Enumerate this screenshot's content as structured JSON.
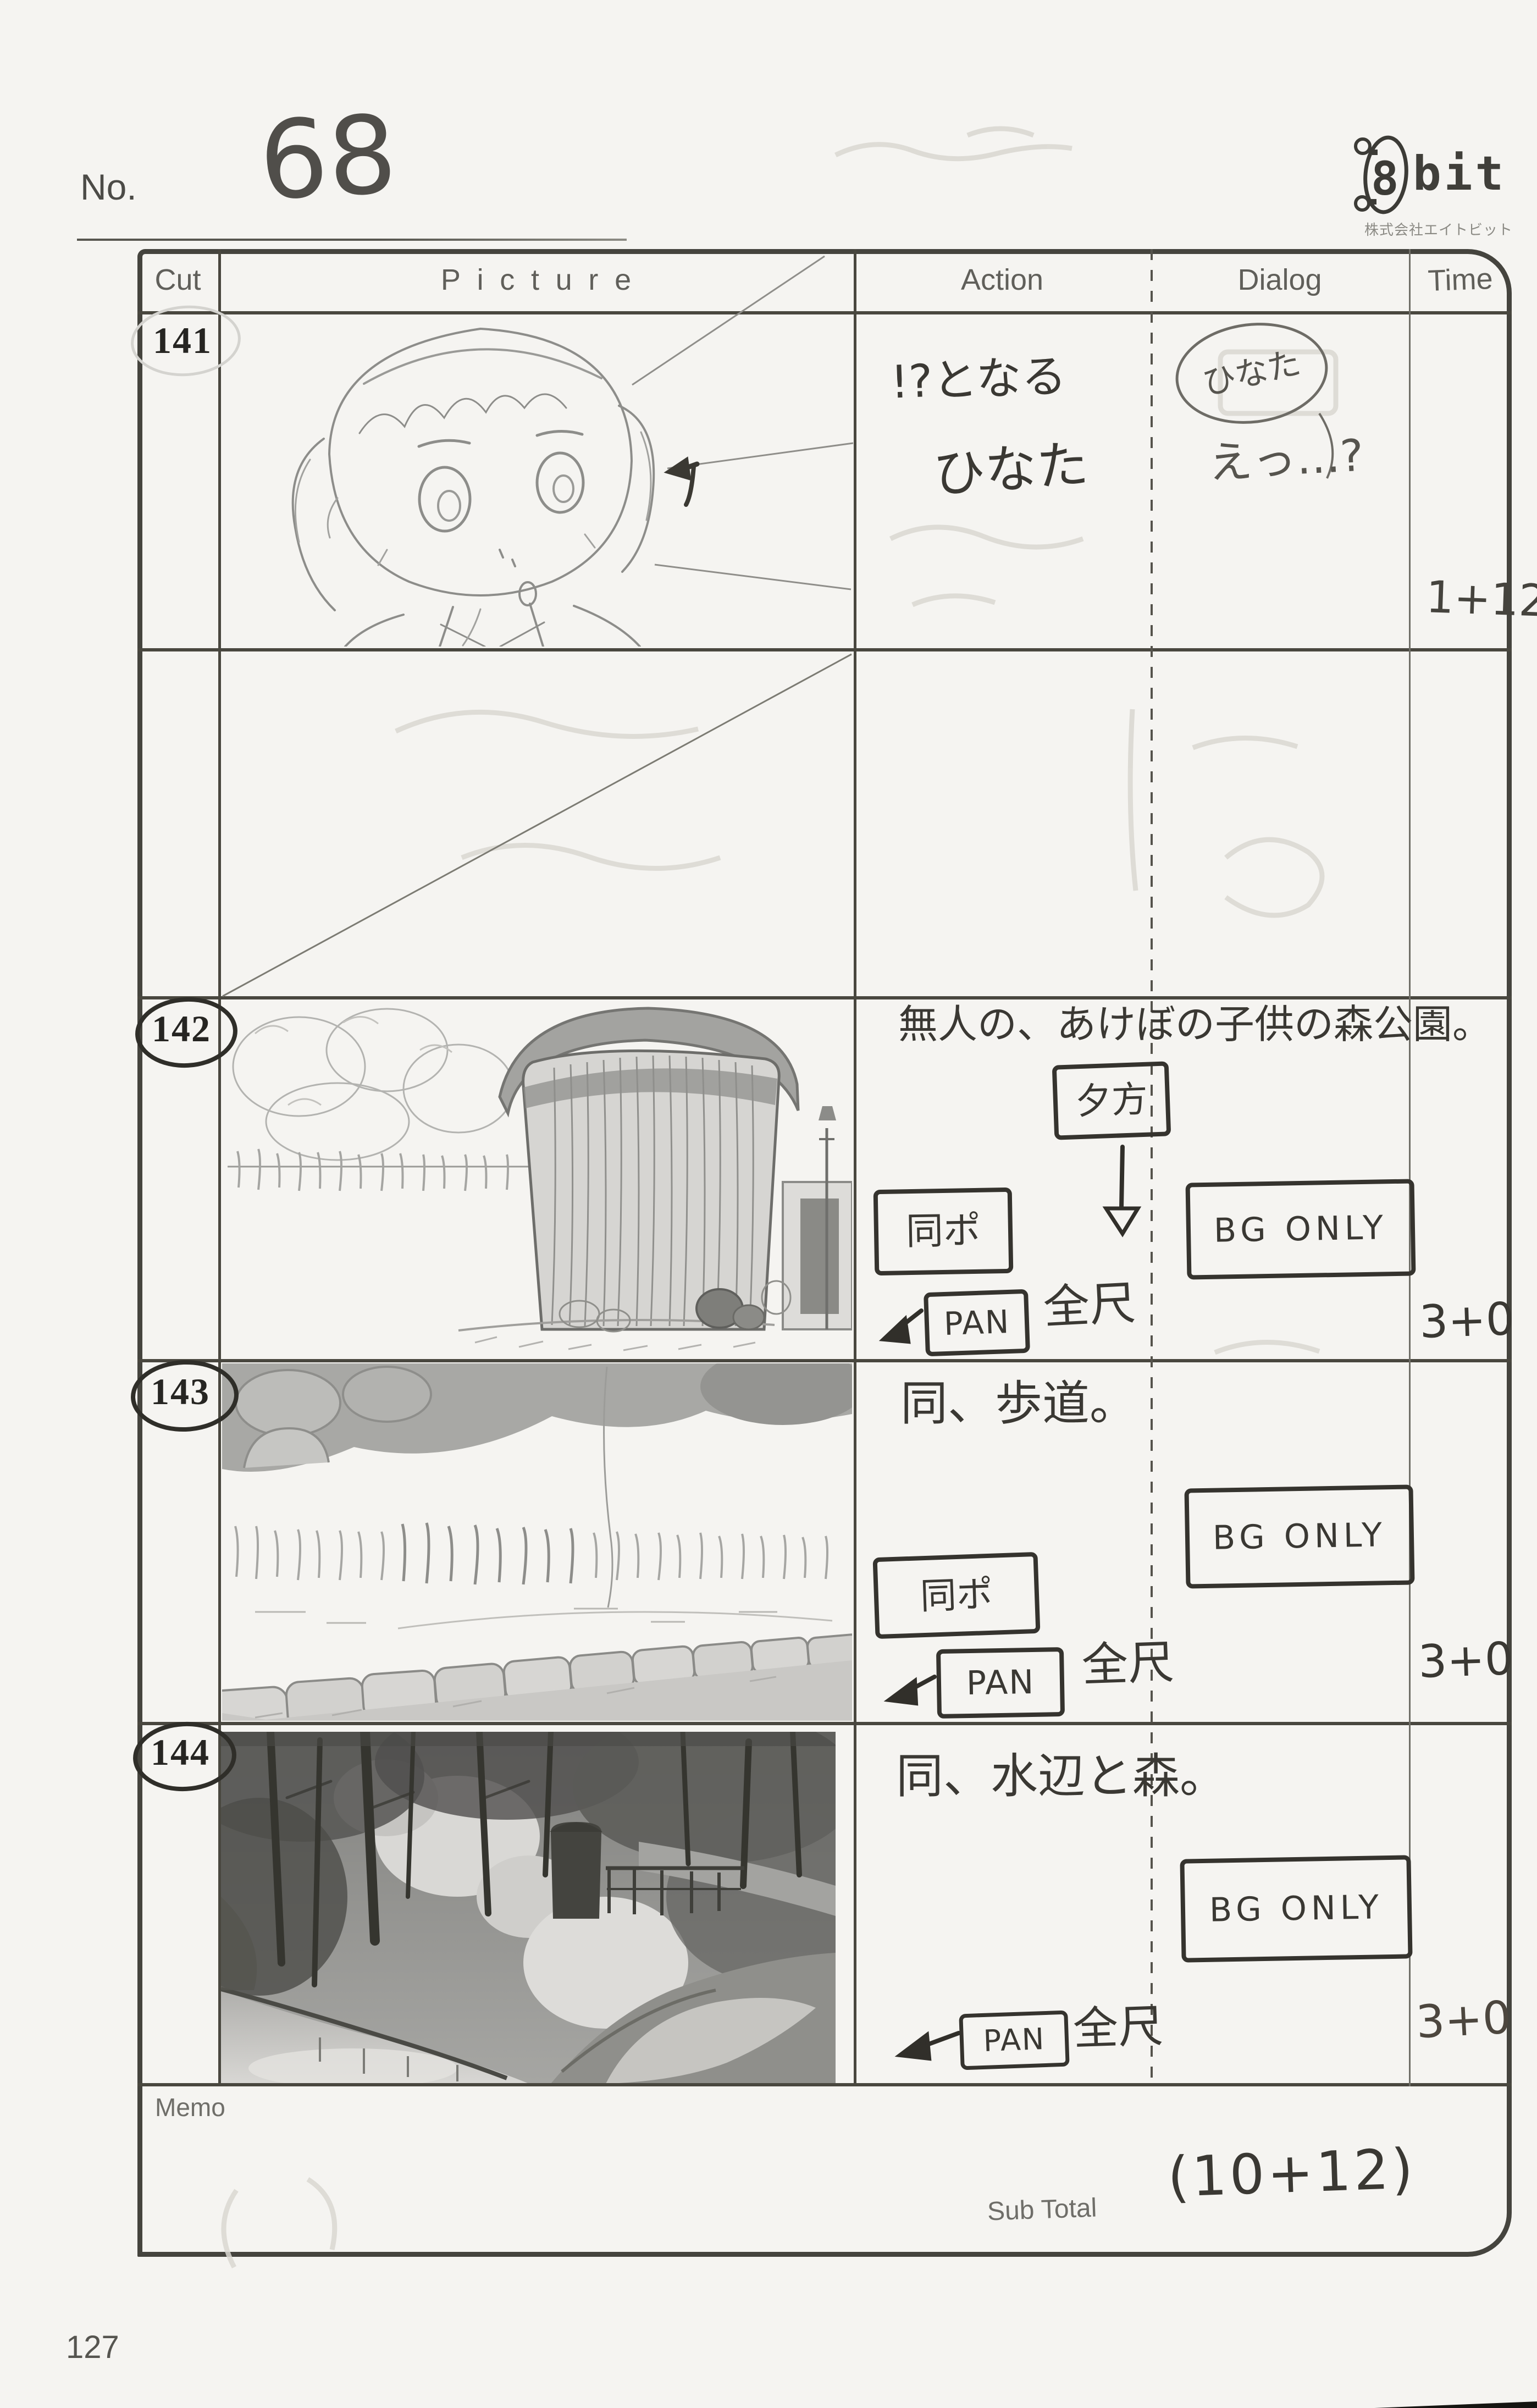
{
  "page": {
    "no_label": "No.",
    "no_value": "68",
    "page_number": "127"
  },
  "logo": {
    "mark": "8",
    "wordmark": "bit",
    "company": "株式会社エイトビット"
  },
  "table": {
    "headers": {
      "cut": "Cut",
      "picture": "Picture",
      "action": "Action",
      "dialog": "Dialog",
      "time": "Time"
    },
    "memo_label": "Memo",
    "sub_total_label": "Sub Total",
    "sub_total_value": "(10+12)"
  },
  "cuts": [
    {
      "number": "141",
      "action_line1": "!?となる",
      "action_line2": "ひなた",
      "dialog_speaker": "ひなた",
      "dialog_text": "えっ…?",
      "time": "1+12"
    },
    {
      "number": "142",
      "scene": "無人の、あけぼの子供の森公園。",
      "time_of_day": "夕方",
      "same_pos": "同ポ",
      "pan": "PAN",
      "pan_extent": "全尺",
      "dialog_note": "BG ONLY",
      "time": "3+0"
    },
    {
      "number": "143",
      "scene": "同、歩道。",
      "same_pos": "同ポ",
      "pan": "PAN",
      "pan_extent": "全尺",
      "dialog_note": "BG ONLY",
      "time": "3+0"
    },
    {
      "number": "144",
      "scene": "同、水辺と森。",
      "pan": "PAN",
      "pan_extent": "全尺",
      "dialog_note": "BG ONLY",
      "time": "3+0"
    }
  ]
}
